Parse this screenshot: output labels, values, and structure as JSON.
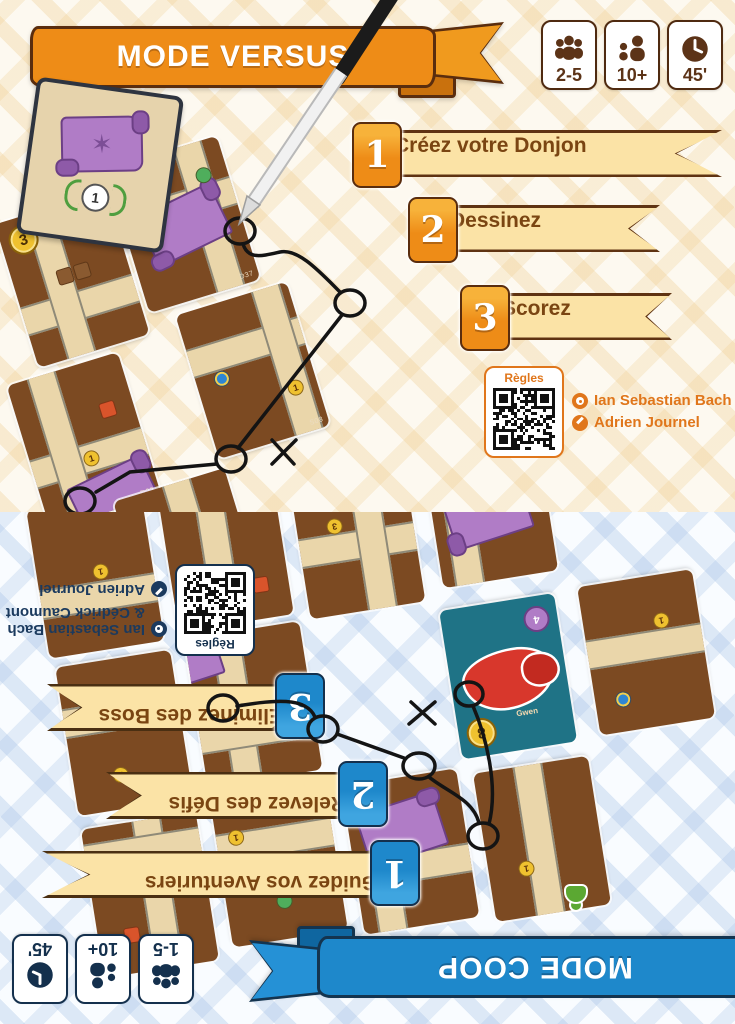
{
  "modes": {
    "versus": {
      "title": "MODE VERSUS",
      "badges": [
        {
          "icon": "players-icon",
          "value": "2-5"
        },
        {
          "icon": "age-icon",
          "value": "10+"
        },
        {
          "icon": "timer-icon",
          "value": "45'"
        }
      ],
      "steps": [
        {
          "number": "1",
          "label": "Créez votre Donjon"
        },
        {
          "number": "2",
          "label": "Dessinez"
        },
        {
          "number": "3",
          "label": "Scorez"
        }
      ],
      "qr_label": "Règles",
      "credits": [
        {
          "role": "designer",
          "name": "Ian Sebastian Bach"
        },
        {
          "role": "illustrator",
          "name": "Adrien Journel"
        }
      ],
      "score_card_value": "1",
      "coin_value": "3",
      "dungeon_card_labels": [
        "D37",
        "D22",
        "S08",
        "S01"
      ],
      "colors": {
        "accent": "#EE8C17",
        "dark": "#5A2D0E",
        "banner_fill": "#FBE3A6",
        "text_on_banner": "#7A4512"
      }
    },
    "coop": {
      "title": "MODE COOP",
      "badges": [
        {
          "icon": "players-icon",
          "value": "1-5"
        },
        {
          "icon": "age-icon",
          "value": "10+"
        },
        {
          "icon": "timer-icon",
          "value": "45'"
        }
      ],
      "steps": [
        {
          "number": "1",
          "label": "Guidez vos Aventuriers"
        },
        {
          "number": "2",
          "label": "Relevez des Défis"
        },
        {
          "number": "3",
          "label": "Éliminez des Boss"
        }
      ],
      "qr_label": "Règles",
      "credits": [
        {
          "role": "designer",
          "name": "Ian Sebastian Bach",
          "name2": "& Cédrick Caumont"
        },
        {
          "role": "illustrator",
          "name": "Adrien Journel"
        }
      ],
      "boss_card": {
        "name": "Gwen",
        "coin": "8",
        "shell": "4"
      },
      "dungeon_card_labels": [
        "B04",
        "B06",
        "B07",
        "B02"
      ],
      "colors": {
        "accent": "#1E88CB",
        "dark": "#14304D",
        "banner_fill": "#FBE3A6",
        "text_on_banner": "#7A4512"
      }
    }
  }
}
